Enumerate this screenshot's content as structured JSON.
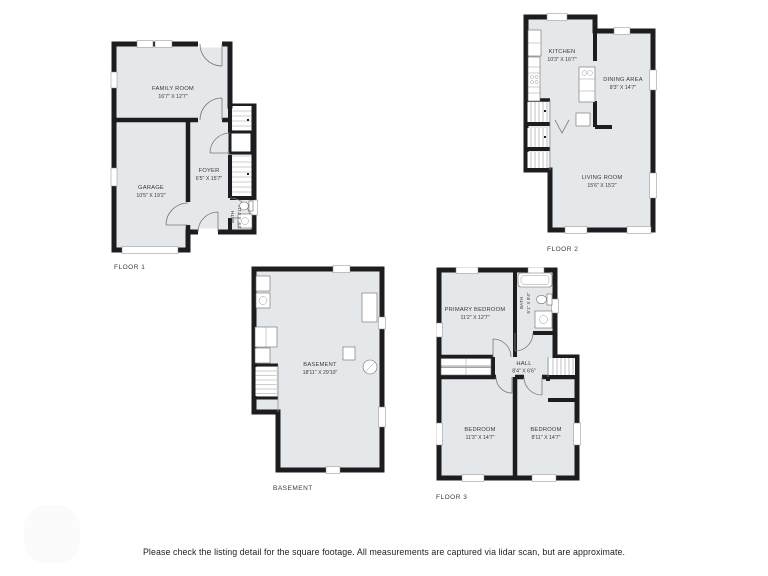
{
  "page": {
    "footer_note": "Please check the listing detail for the square footage. All measurements are captured via lidar scan, but are approximate."
  },
  "colors": {
    "wall": "#1d1d1f",
    "room_fill": "#e4e8eb",
    "label_text": "#3a3a3a",
    "background": "#ffffff"
  },
  "icons": {
    "fixtures": "stairs-icon, door-swing-icon, toilet-icon, sink-icon, bathtub-icon, washer-icon, dryer-icon, water-heater-icon, kitchen-counter-icon, closet-icon"
  },
  "floors": {
    "floor1": {
      "label": "FLOOR 1",
      "rooms": {
        "family_room": {
          "name": "FAMILY ROOM",
          "dims": "16'7\" X 12'7\""
        },
        "garage": {
          "name": "GARAGE",
          "dims": "10'5\" X 19'2\""
        },
        "foyer": {
          "name": "FOYER",
          "dims": "6'5\" X 15'7\""
        },
        "bath": {
          "name": "BATH",
          "dims": "3'9\" X 4'11\""
        }
      }
    },
    "floor2": {
      "label": "FLOOR 2",
      "rooms": {
        "kitchen": {
          "name": "KITCHEN",
          "dims": "10'3\" X 16'7\""
        },
        "dining_area": {
          "name": "DINING AREA",
          "dims": "8'3\" X 14'7\""
        },
        "living_room": {
          "name": "LIVING ROOM",
          "dims": "15'6\" X 15'2\""
        }
      }
    },
    "basement": {
      "label": "BASEMENT",
      "rooms": {
        "basement": {
          "name": "BASEMENT",
          "dims": "18'11\" X 29'10\""
        }
      }
    },
    "floor3": {
      "label": "FLOOR 3",
      "rooms": {
        "primary_bedroom": {
          "name": "PRIMARY BEDROOM",
          "dims": "11'2\" X 12'7\""
        },
        "bath": {
          "name": "BATH",
          "dims": "5'1\" X 9'4\""
        },
        "hall": {
          "name": "HALL",
          "dims": "8'4\" X 6'6\""
        },
        "bedroom_1": {
          "name": "BEDROOM",
          "dims": "11'3\" X 14'7\""
        },
        "bedroom_2": {
          "name": "BEDROOM",
          "dims": "8'11\" X 14'7\""
        }
      }
    }
  }
}
